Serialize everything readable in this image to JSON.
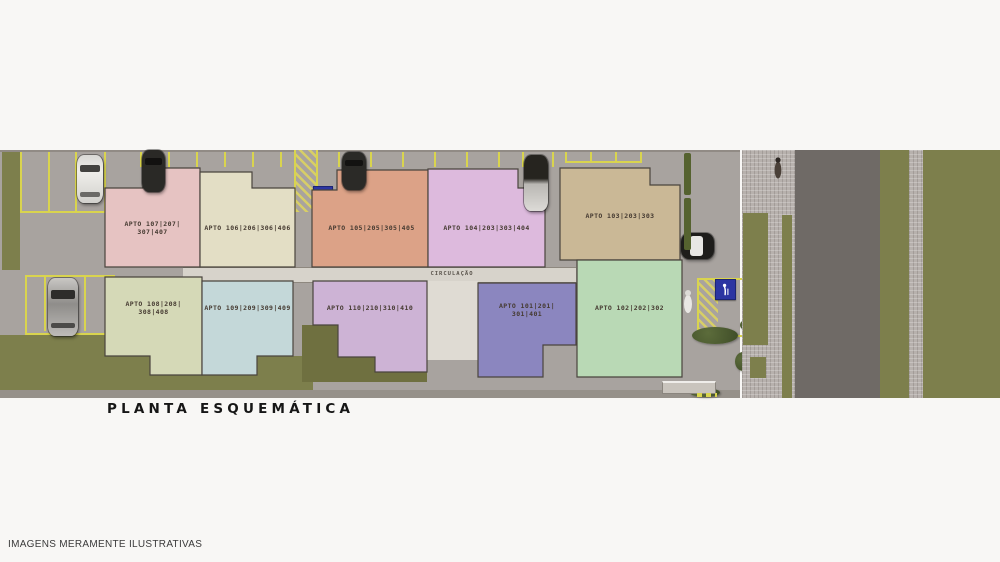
{
  "page": {
    "title": "PLANTA ESQUEMÁTICA",
    "disclaimer": "IMAGENS MERAMENTE ILUSTRATIVAS"
  },
  "plan": {
    "circulation_label": "CIRCULAÇÃO",
    "apartments": [
      {
        "id": "apto-107",
        "line1": "APTO 107|207|",
        "line2": "307|407",
        "color": "#e6c3c2"
      },
      {
        "id": "apto-106",
        "line1": "APTO 106|206|306|406",
        "line2": "",
        "color": "#e3dec5"
      },
      {
        "id": "apto-105",
        "line1": "APTO 105|205|305|405",
        "line2": "",
        "color": "#dca287"
      },
      {
        "id": "apto-104",
        "line1": "APTO 104|203|303|404",
        "line2": "",
        "color": "#ddbadd"
      },
      {
        "id": "apto-103",
        "line1": "APTO 103|203|303",
        "line2": "",
        "color": "#cab896"
      },
      {
        "id": "apto-108",
        "line1": "APTO 108|208|",
        "line2": "308|408",
        "color": "#d5d9b7"
      },
      {
        "id": "apto-109",
        "line1": "APTO 109|209|309|409",
        "line2": "",
        "color": "#c4d8d9"
      },
      {
        "id": "apto-110",
        "line1": "APTO 110|210|310|410",
        "line2": "",
        "color": "#cdb3d5"
      },
      {
        "id": "apto-101",
        "line1": "APTO 101|201|",
        "line2": "301|401",
        "color": "#8b86bf"
      },
      {
        "id": "apto-102",
        "line1": "APTO 102|202|302",
        "line2": "",
        "color": "#b9d9b5"
      }
    ],
    "signs": {
      "accessible_parking_icon": "wheelchair",
      "senior_parking_icon": "person-with-cane"
    },
    "colors": {
      "grass": "#7d7f4c",
      "ground": "#a8a39f",
      "road": "#6f6a66",
      "pavement": "#b7b1ad",
      "parking_line_yellow": "#d9d44e",
      "circulation": "#d7d3cb",
      "sign_blue": "#2c35a2",
      "building_outline": "#4a443e"
    }
  }
}
